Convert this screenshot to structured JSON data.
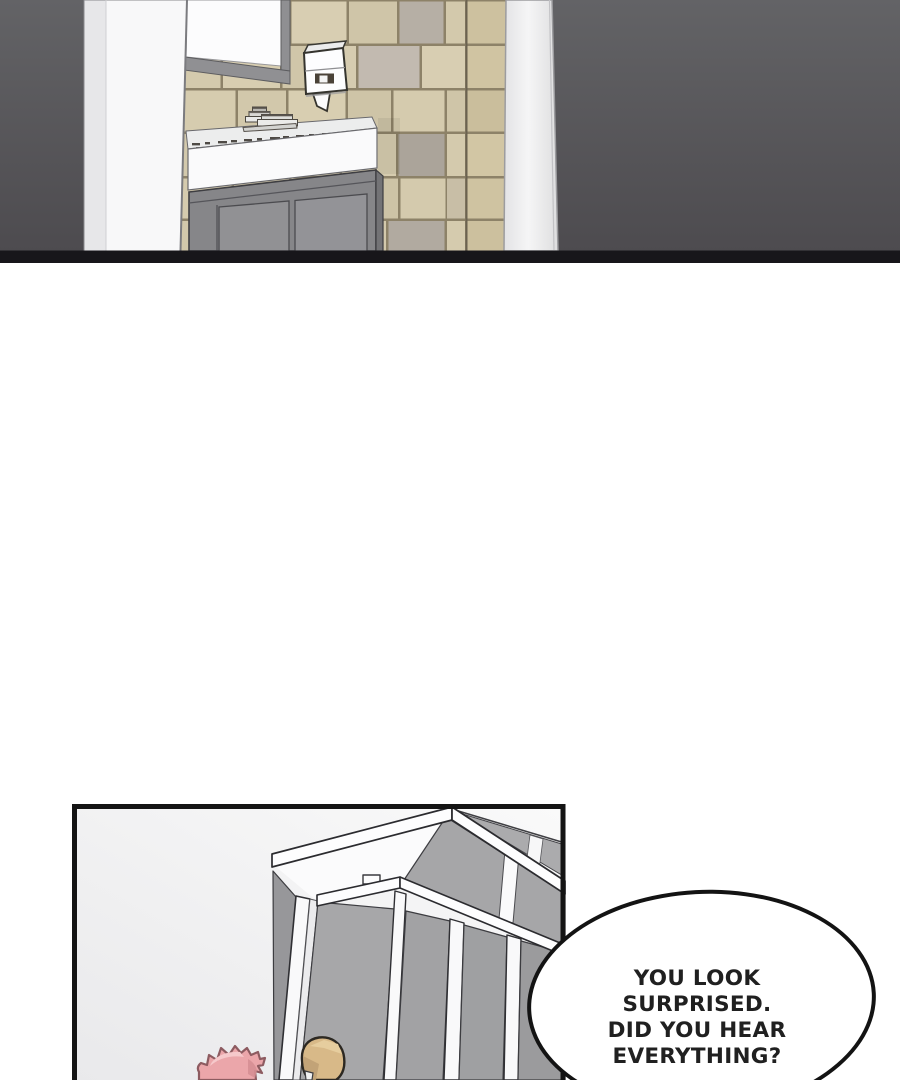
{
  "page": {
    "type": "webtoon comic episode page",
    "background": "#ffffff"
  },
  "panels": [
    {
      "id": "panel-1",
      "description": "Bathroom interior: wall mirror, paper towel dispenser, beige stone-tiled wall, white sink counter with faucet, gray vanity cabinet, dark gray backdrop, full-width panel cut at top"
    },
    {
      "id": "panel-2",
      "description": "Bright room with a white-framed gray partition cubicle; a pink-haired character and a tan-haired character peek up from the bottom edge"
    }
  ],
  "speech_bubble": {
    "lines": [
      "YOU LOOK",
      "SURPRISED.",
      "DID YOU HEAR",
      "EVERYTHING?"
    ],
    "fill": "#ffffff",
    "outline": "#131313",
    "text_color": "#202020"
  },
  "palette": {
    "backdrop_top": "#636366",
    "backdrop_bottom": "#4c4a4e",
    "tile_beige": "#d4caad",
    "tile_grout": "#8d8268",
    "mirror_frame": "#909093",
    "counter_white": "#fafafb",
    "cabinet_gray": "#868689",
    "partition_panel_gray": "#a2a2a4",
    "partition_frame_white": "#fdfdfe",
    "hair_pink": "#eba6aa",
    "hair_tan": "#d8b988",
    "panel_border": "#141414"
  }
}
